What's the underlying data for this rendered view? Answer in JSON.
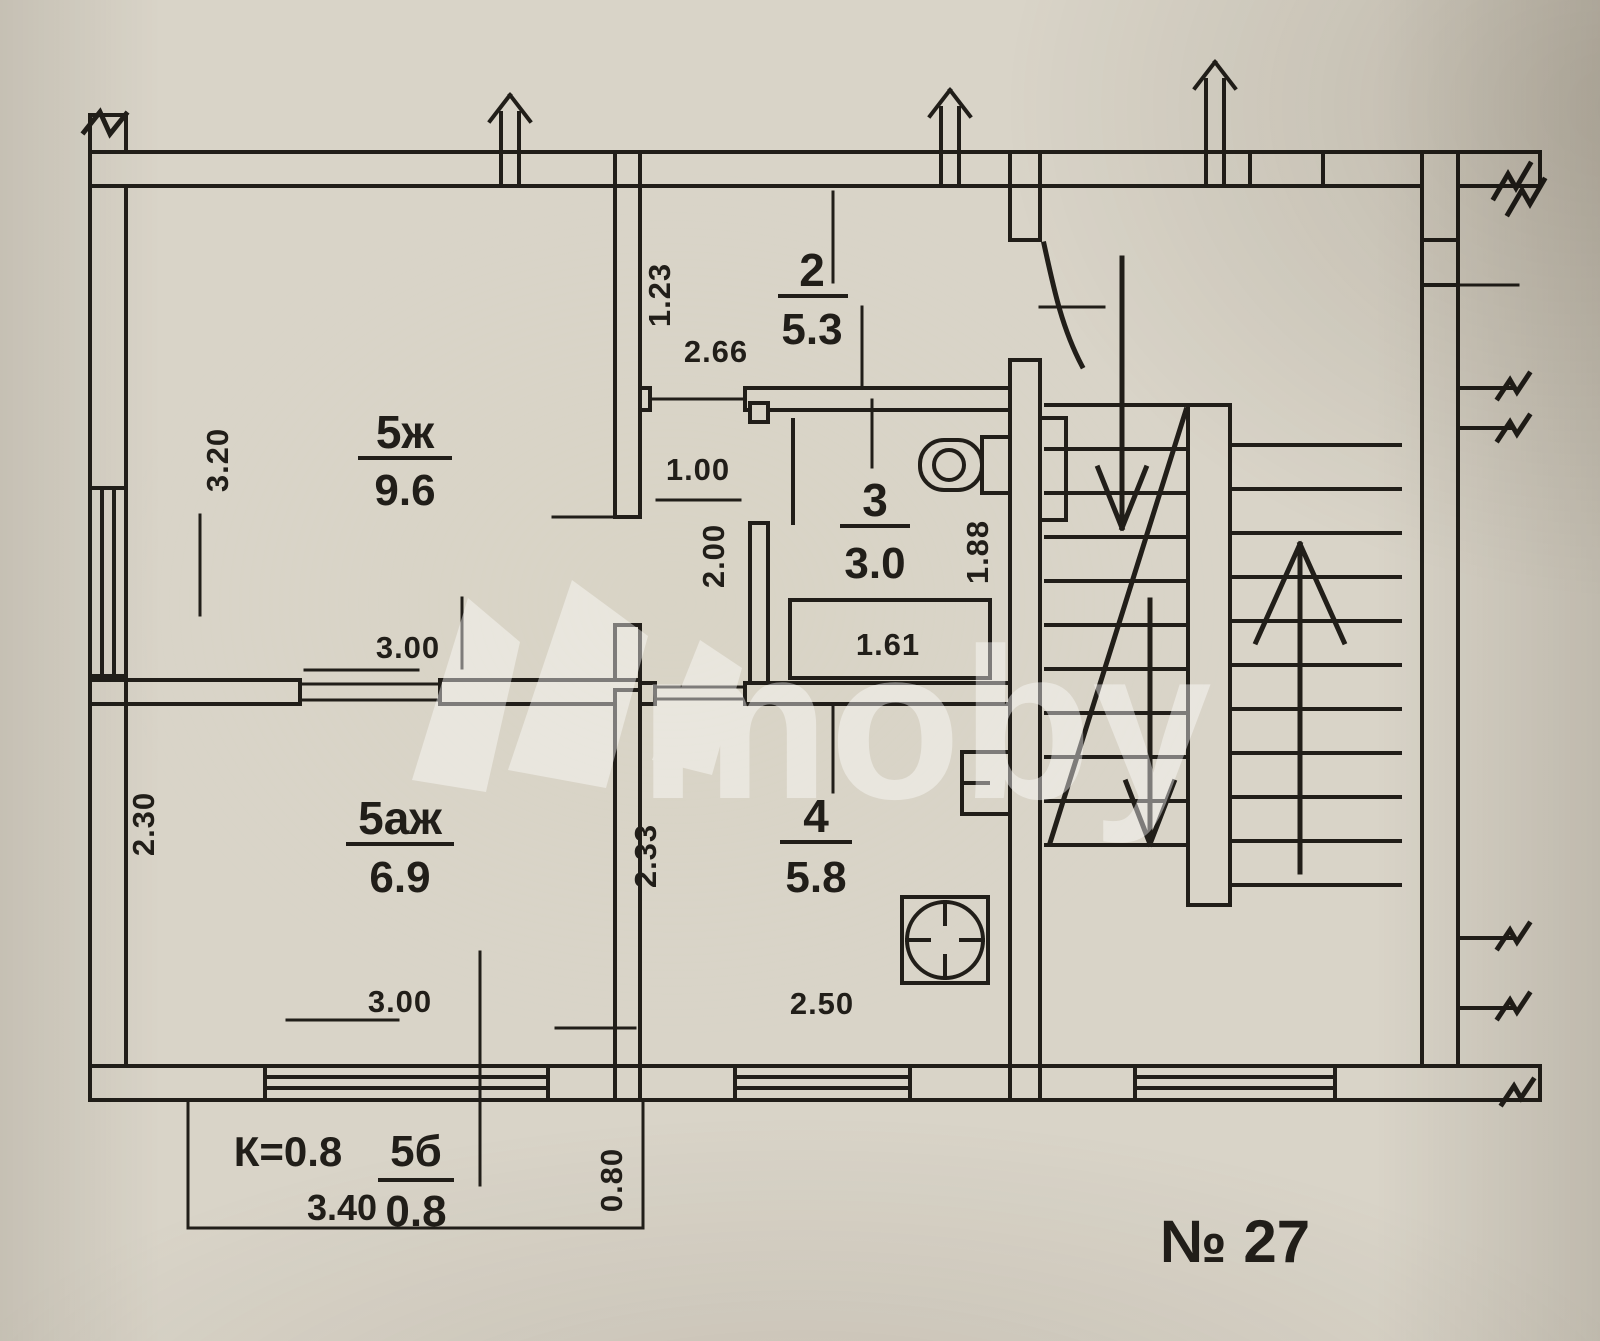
{
  "meta": {
    "plan_number": "№ 27",
    "watermark_text": "moby"
  },
  "rooms": {
    "living": {
      "id": "5ж",
      "area": "9.6"
    },
    "hall": {
      "id": "2",
      "area": "5.3"
    },
    "bath": {
      "id": "3",
      "area": "3.0"
    },
    "kitchen": {
      "id": "4",
      "area": "5.8"
    },
    "room2": {
      "id": "5аж",
      "area": "6.9"
    },
    "balcony": {
      "id": "5б",
      "area": "0.8",
      "coefficient": "К=0.8"
    }
  },
  "dimensions": {
    "living_width": "3.20",
    "living_depth": "3.00",
    "hall_height": "1.23",
    "hall_width": "2.66",
    "corridor_width": "1.00",
    "corridor_depth": "2.00",
    "bath_depth": "1.88",
    "bathtub_length": "1.61",
    "room2_width": "2.30",
    "room2_depth": "3.00",
    "kitchen_height": "2.33",
    "kitchen_width": "2.50",
    "balcony_width": "3.40",
    "balcony_depth": "0.80"
  },
  "colors": {
    "ink": "#211e19",
    "paper": "#d9d4c8"
  }
}
